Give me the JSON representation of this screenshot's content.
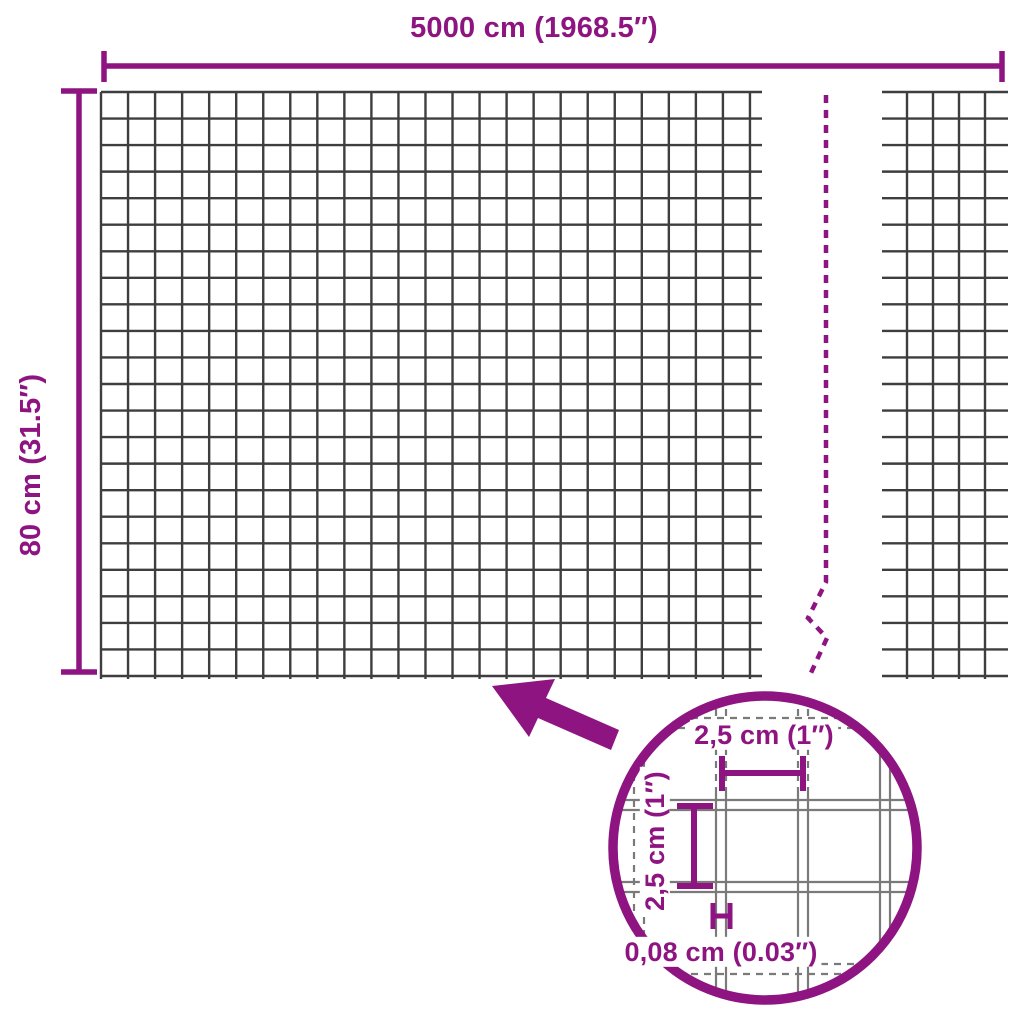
{
  "page": {
    "background": "#ffffff"
  },
  "colors": {
    "accent": "#8e1581",
    "wire": "#3e3e3e",
    "detail_wire": "#7a7a7a",
    "background": "#ffffff"
  },
  "labels": {
    "width": "5000 cm (1968.5″)",
    "height": "80 cm (31.5″)",
    "detail_width": "2,5 cm (1″)",
    "detail_height": "2,5 cm (1″)",
    "wire_thickness": "0,08 cm (0.03″)"
  },
  "geometry": {
    "canvas": {
      "w": 1024,
      "h": 1024
    },
    "main_grid": {
      "x_first": 101,
      "x_count": 25,
      "x_step": 27.04,
      "y_first": 92,
      "y_count": 23,
      "y_step": 26.545,
      "h_x1": 101,
      "h_x2": 762,
      "v_y1": 92,
      "v_y2": 679,
      "stroke_w": 2.4
    },
    "right_grid": {
      "x_first": 907,
      "x_count": 4,
      "x_step": 26,
      "y_first": 92,
      "y_count": 23,
      "y_step": 26.545,
      "h_x1": 882,
      "h_x2": 1008,
      "v_y1": 92,
      "v_y2": 679,
      "stroke_w": 2.4
    },
    "break_line": {
      "path": "M826,95 L826,582 L808,618 L827,638 L810,675",
      "stroke_w": 4.5,
      "dash": "8 7"
    },
    "top_dim": {
      "y": 66,
      "x1": 104,
      "x2": 1002,
      "cap_y1": 51,
      "cap_y2": 82,
      "stroke_w": 5.5
    },
    "left_dim": {
      "x": 79,
      "y1": 91,
      "y2": 672,
      "cap_x1": 61,
      "cap_x2": 97,
      "stroke_w": 5.5
    },
    "arrow_points": "492,686 555,679 546,698 619,730 611,750 538,718 529,737",
    "detail": {
      "cx": 765,
      "cy": 848,
      "r": 152,
      "outline_w": 9.5,
      "wire_w": 2.2,
      "dash": "7 6",
      "solid_from_y": 792,
      "v_pairs": [
        {
          "x": [
            634,
            644
          ],
          "style": "dash-all"
        },
        {
          "x": [
            716,
            726
          ],
          "style": "dash-top"
        },
        {
          "x": [
            798,
            808
          ],
          "style": "dash-top"
        },
        {
          "x": [
            880,
            890
          ],
          "style": "solid"
        }
      ],
      "h_pairs": [
        {
          "y": [
            718,
            728
          ],
          "style": "dash-all"
        },
        {
          "y": [
            800,
            810
          ],
          "style": "solid"
        },
        {
          "y": [
            882,
            892
          ],
          "style": "solid"
        },
        {
          "y": [
            964,
            974
          ],
          "style": "dash-all"
        }
      ],
      "hdim": {
        "y": 773,
        "x1": 722,
        "x2": 803,
        "cap_y1": 756,
        "cap_y2": 791,
        "w": 6
      },
      "vdim": {
        "x": 694,
        "y1": 806,
        "y2": 886,
        "cap_x1": 677,
        "cap_x2": 713,
        "w": 6
      },
      "thick": {
        "x1": 713,
        "x2": 730,
        "y1": 903,
        "y2": 929,
        "mid_y": 916,
        "w": 5
      }
    },
    "label_pos": {
      "width": {
        "x": 534,
        "y": 28
      },
      "height": {
        "x": 31,
        "y": 465
      },
      "detail_width": {
        "x": 764,
        "y": 735
      },
      "detail_height": {
        "x": 655,
        "y": 841
      },
      "wire_thickness": {
        "x": 721,
        "y": 952
      }
    }
  }
}
